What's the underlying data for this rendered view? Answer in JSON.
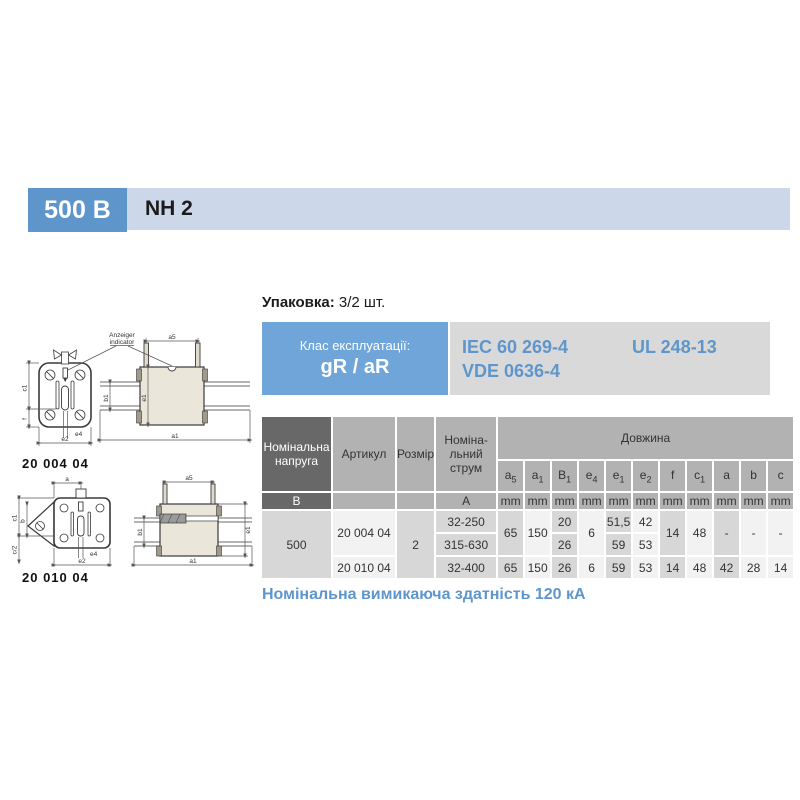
{
  "colors": {
    "accent_blue": "#5e96cc",
    "class_box_blue": "#6fa5d8",
    "header_bar_bg": "#ccd8ea",
    "standards_bg": "#d9d9d9",
    "standards_text": "#5e96cc",
    "note_text": "#5e96cc",
    "table_dark_header": "#686868",
    "table_gray_header": "#b2b2b2",
    "cell_shaded": "#d7d7d7",
    "cell_light": "#f2f2f2"
  },
  "header": {
    "voltage_badge": "500 В",
    "series_label": "NH 2"
  },
  "packaging": {
    "label": "Упаковка:",
    "value": "3/2 шт."
  },
  "class_box": {
    "label": "Клас експлуатації:",
    "value": "gR / aR"
  },
  "standards": {
    "iec": "IEC 60 269-4",
    "vde": "VDE 0636-4",
    "ul": "UL 248-13"
  },
  "note": "Номінальна вимикаюча здатність 120 кА",
  "drawings": [
    {
      "caption": "20 004 04",
      "labels": {
        "anzeiger_line1": "Anzeiger",
        "anzeiger_line2": "indicator",
        "a5": "a5",
        "c1": "c1",
        "f": "f",
        "e4": "e4",
        "e2": "e2",
        "b1": "b1",
        "e1": "e1",
        "a1": "a1"
      }
    },
    {
      "caption": "20 010 04",
      "labels": {
        "a": "a",
        "c1": "c1",
        "b": "b",
        "c_half": "c/2",
        "e4": "e4",
        "e2": "e2",
        "a5": "a5",
        "b1": "b1",
        "e1": "e1",
        "a1": "a1"
      }
    }
  ],
  "table": {
    "headers": {
      "voltage": "Номінальна\nнапруга",
      "article": "Артикул",
      "size": "Розмір",
      "current": "Номіна-\nльний\nструм",
      "length_group": "Довжина"
    },
    "dims": [
      {
        "b": "a",
        "s": "5"
      },
      {
        "b": "a",
        "s": "1"
      },
      {
        "b": "B",
        "s": "1"
      },
      {
        "b": "e",
        "s": "4"
      },
      {
        "b": "e",
        "s": "1"
      },
      {
        "b": "e",
        "s": "2"
      },
      {
        "b": "f",
        "s": ""
      },
      {
        "b": "c",
        "s": "1"
      },
      {
        "b": "a",
        "s": ""
      },
      {
        "b": "b",
        "s": ""
      },
      {
        "b": "c",
        "s": ""
      }
    ],
    "units": {
      "voltage": "В",
      "current": "A",
      "mm": "mm"
    },
    "rows": {
      "voltage": "500",
      "groups": [
        {
          "article": "20 004 04",
          "size": "2",
          "sub": [
            {
              "current": "32-250",
              "B1": "20",
              "e1": "51,5",
              "e2": "42"
            },
            {
              "current": "315-630",
              "B1": "26",
              "e1": "59",
              "e2": "53"
            }
          ],
          "shared": {
            "a5": "65",
            "a1": "150",
            "e4": "6",
            "f": "14",
            "c1": "48",
            "a": "-",
            "b": "-",
            "c": "-"
          }
        },
        {
          "article": "20 010 04",
          "row": {
            "current": "32-400",
            "a5": "65",
            "a1": "150",
            "B1": "26",
            "e4": "6",
            "e1": "59",
            "e2": "53",
            "f": "14",
            "c1": "48",
            "a": "42",
            "b": "28",
            "c": "14"
          }
        }
      ]
    }
  }
}
